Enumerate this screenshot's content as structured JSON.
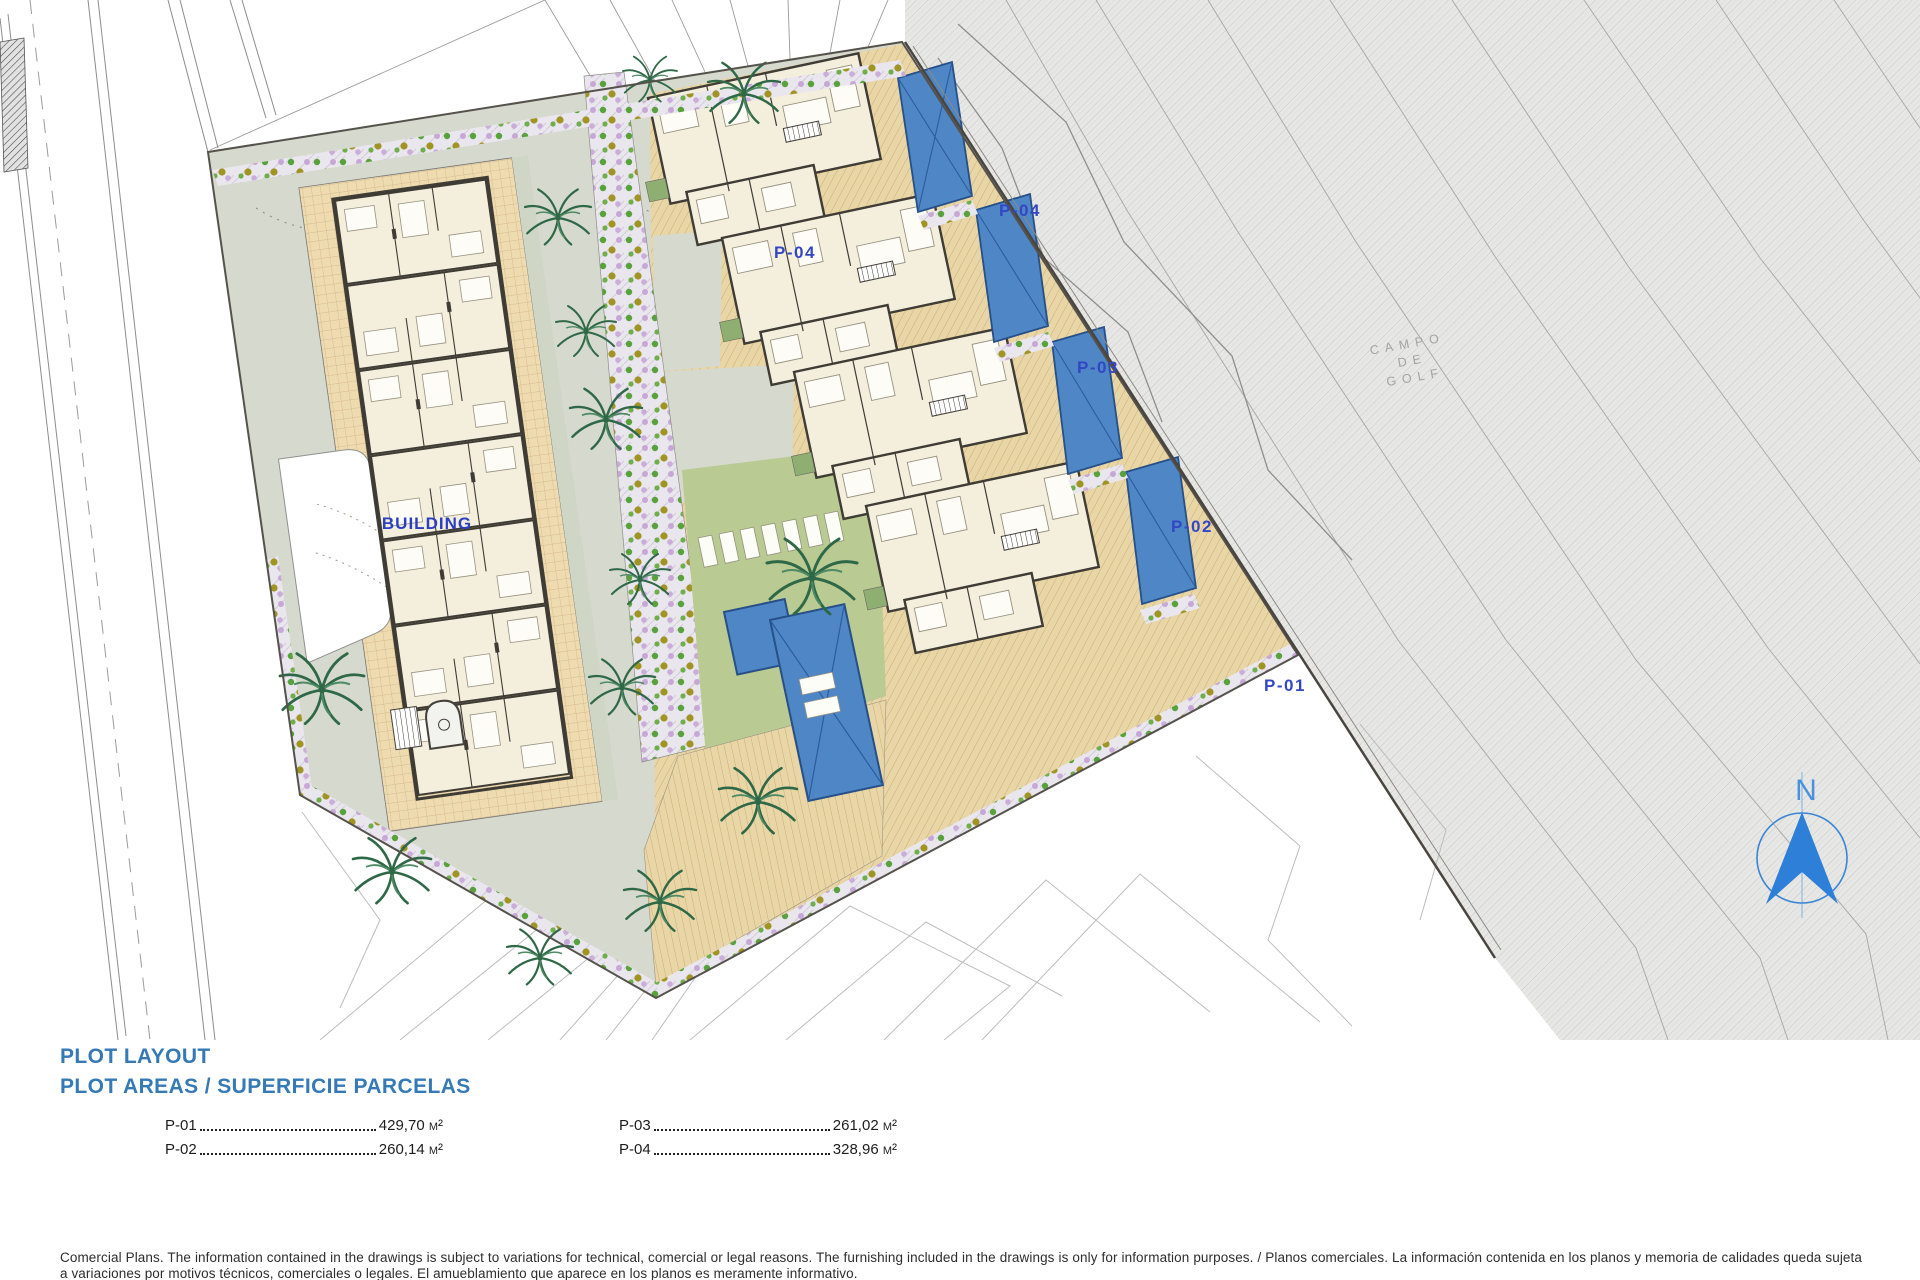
{
  "plan": {
    "building_label": "BUILDING",
    "plot_labels": {
      "p01": "P-01",
      "p02": "P-02",
      "p03": "P-03",
      "p04": "P-04",
      "p04_secondary": "P-04"
    },
    "golf_course_label": {
      "line1": "CAMPO",
      "line2": "DE",
      "line3": "GOLF"
    },
    "north_label": "N"
  },
  "legend": {
    "title_line1": "PLOT LAYOUT",
    "title_line2": "PLOT AREAS / SUPERFICIE PARCELAS",
    "plots": [
      {
        "label": "P-01",
        "area": "429,70 m²"
      },
      {
        "label": "P-02",
        "area": "260,14 m²"
      },
      {
        "label": "P-03",
        "area": "261,02 m²"
      },
      {
        "label": "P-04",
        "area": "328,96 m²"
      }
    ]
  },
  "disclaimer": {
    "en": "Comercial Plans. The information contained in the drawings is subject to variations for technical, comercial or legal reasons. The furnishing included in the drawings is only for information purposes. /",
    "es": "Planos comerciales. La información contenida en los planos y memoria de calidades queda sujeta a variaciones por motivos técnicos, comerciales o legales. El amueblamiento que aparece en los planos es meramente informativo."
  },
  "colors": {
    "accent_blue": "#3579b5",
    "label_blue": "#3347c5",
    "pool_blue": "#4e86c6",
    "north_blue": "#2e7fd8",
    "lawn_green": "#b9ca92",
    "terrace_tan": "#e9d6a6",
    "golf_gray": "#e7e7e5"
  }
}
